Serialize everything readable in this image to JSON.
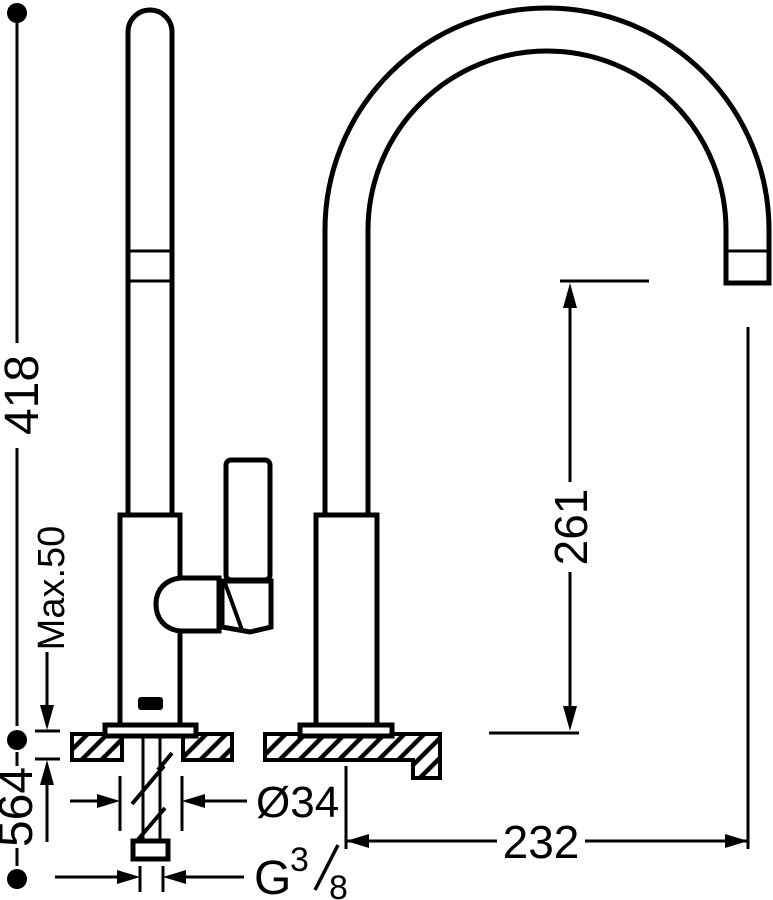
{
  "colors": {
    "ink": "#000000",
    "paper": "#ffffff"
  },
  "dimensions": {
    "height_above_counter": "418",
    "max_counter_thickness": "Max.50",
    "under_counter_length": "564",
    "body_diameter": "Ø34",
    "inlet_thread_prefix": "G",
    "inlet_thread_numerator": "3",
    "inlet_thread_denominator": "8",
    "spout_outlet_height": "261",
    "spout_reach": "232"
  }
}
